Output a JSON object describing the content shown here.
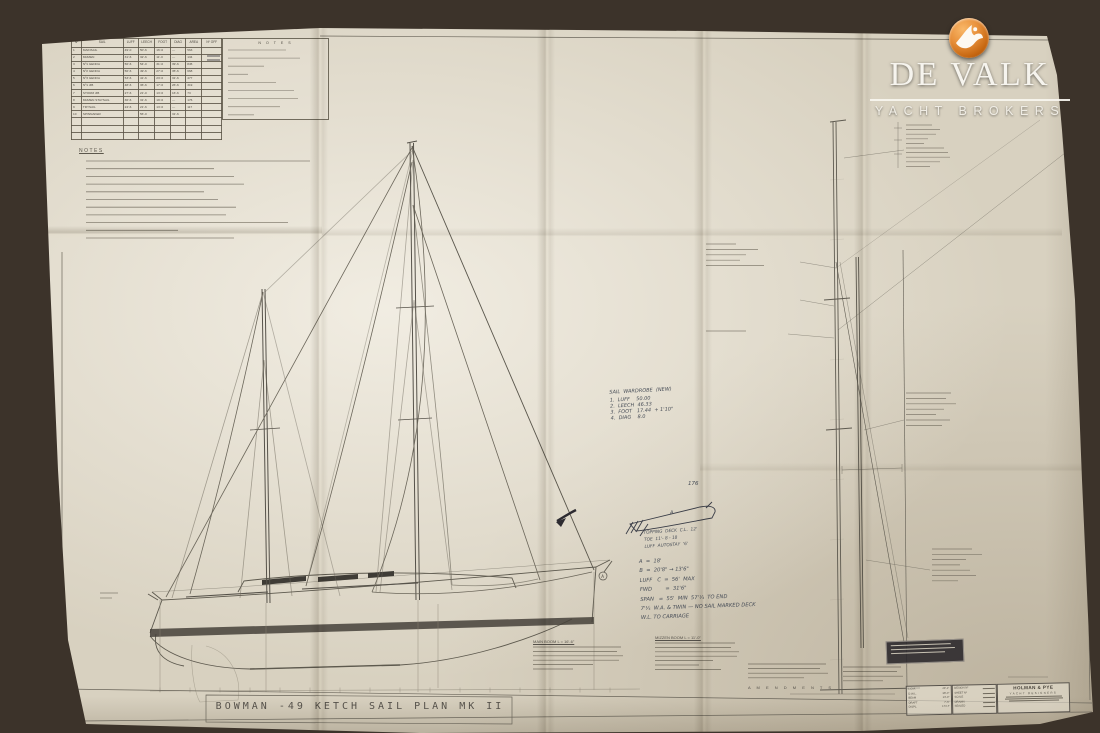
{
  "logo": {
    "brand": "DE VALK",
    "tagline": "YACHT BROKERS",
    "icon": "falcon-badge",
    "badge_color": "#d9831f"
  },
  "plan": {
    "title": "BOWMAN  -49   KETCH   SAIL  PLAN    MK II",
    "notes_panel_title": "N O T E S",
    "notes_heading": "NOTES",
    "station_label": "A",
    "sail_table": {
      "headers": [
        "Nº",
        "SAIL",
        "LUFF",
        "LEECH",
        "FOOT",
        "DIAG",
        "AREA",
        "Nº OFF"
      ],
      "rows": [
        [
          "1",
          "MAINSAIL",
          "49'-0",
          "50'-6",
          "16'-6",
          "—",
          "563",
          ""
        ],
        [
          "2",
          "MIZZEN",
          "31'-6",
          "32'-6",
          "11'-0",
          "—",
          "134",
          ""
        ],
        [
          "3",
          "Nº1 GENOA",
          "56'-6",
          "54'-0",
          "31'-0",
          "39'-6",
          "845",
          ""
        ],
        [
          "4",
          "Nº2 GENOA",
          "56'-6",
          "49'-6",
          "27'-0",
          "35'-6",
          "668",
          ""
        ],
        [
          "5",
          "Nº3 GENOA",
          "53'-6",
          "41'-6",
          "23'-6",
          "31'-6",
          "477",
          ""
        ],
        [
          "6",
          "Nº1 JIB",
          "48'-6",
          "36'-6",
          "17'-6",
          "26'-6",
          "319",
          ""
        ],
        [
          "7",
          "STORM JIB",
          "27'-6",
          "21'-0",
          "13'-6",
          "16'-6",
          "73",
          ""
        ],
        [
          "8",
          "MIZZEN STAYSAIL",
          "36'-6",
          "31'-6",
          "19'-6",
          "—",
          "176",
          ""
        ],
        [
          "9",
          "TRYSAIL",
          "24'-6",
          "21'-6",
          "13'-6",
          "—",
          "117",
          ""
        ],
        [
          "10",
          "SPINNAKER",
          "",
          "56'-0",
          "",
          "31'-6",
          "",
          ""
        ]
      ]
    },
    "spec_blocks": {
      "main_boom": "MAIN BOOM   L = 16'-6\"",
      "mizzen_boom": "MIZZEN BOOM   L = 11'-0\"",
      "amendments": "A M E N D M E N T S"
    },
    "handwritten": {
      "wardrobe_title": "SAIL  WARDROBE  (NEW)",
      "wardrobe_items": [
        "1.  LUFF    50.00",
        "2.  LEECH  46.33",
        "3.  FOOT   17.44  + 1'10\"",
        "4.  DIAG    8.0"
      ],
      "boom_note": [
        "TOPPING  DECK  C.L.  12'",
        "TOE  11'- 8 - 18",
        "LUFF  AUTOSTAY  '6'"
      ],
      "boom_label": "A",
      "dims": [
        "A  =  18'",
        "B  =  20'8\" → 13'6\"",
        "LUFF   C  =  56'  MAX",
        "FWD        =  31'6\"",
        "SPAN   =  55'  MIN  57'¼  TO END",
        "7'¼  W.A. & TWIN — NO SAIL MARKED DECK",
        "W.L. TO CARRIAGE"
      ],
      "misc_number": "176"
    },
    "title_block": {
      "dimensions": [
        [
          "L.O.A.",
          "49'-1\""
        ],
        [
          "D.W.L.",
          "38'-0\""
        ],
        [
          "BEAM",
          "13'-9\""
        ],
        [
          "DRAFT",
          "7'-6\""
        ],
        [
          "DISPL.",
          "17½ T"
        ]
      ],
      "admin_labels": [
        "DESIGN Nº",
        "SHEET Nº",
        "SCALE",
        "DRAWN",
        "SEALED"
      ],
      "firm": {
        "name": "HOLMAN & PYE",
        "subtitle": "YACHT DESIGNERS"
      }
    }
  }
}
